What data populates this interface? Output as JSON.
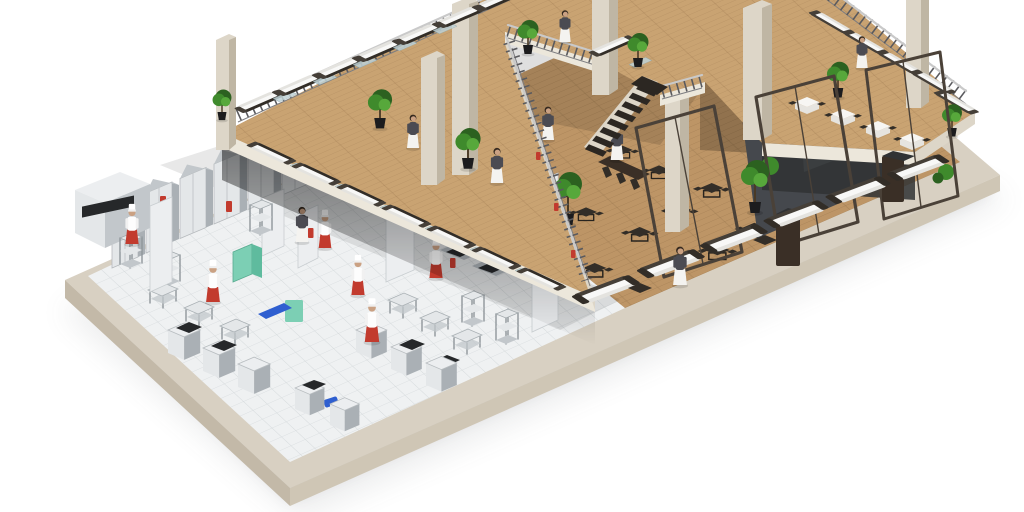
{
  "image": {
    "width": 1024,
    "height": 512,
    "alt": "3D isometric cutaway rendering of a two-storey restaurant"
  },
  "scene": {
    "style": "photorealistic 3D isometric cutaway architectural render on white background",
    "subject": "Two-storey restaurant interior: open commercial kitchen on the ground floor and a lounge dining mezzanine above",
    "background_color": "#ffffff",
    "levels": [
      {
        "name": "ground-floor",
        "areas": [
          {
            "name": "commercial-kitchen",
            "floor": "white ceramic tile",
            "equipment": [
              "tall stainless refrigerator cabinets",
              "stainless prep tables",
              "wire shelving racks",
              "ranges with black cooktops",
              "black-front oven",
              "teal dishwasher machine",
              "blue prep bins",
              "red wall panels"
            ],
            "staff": "chefs"
          },
          {
            "name": "dining-hall",
            "floor": "oak plank",
            "furniture": [
              "dark square tables with chairs",
              "long communal table",
              "framed glass partition walls",
              "dark host cabinets",
              "potted ficus trees",
              "railing with red accents"
            ],
            "staff": "waitresses"
          },
          {
            "name": "terrace-edge-lounge",
            "floor": "beige walkway strip",
            "furniture": [
              "rattan sofas with white cushions",
              "dark side tables"
            ]
          }
        ]
      },
      {
        "name": "mezzanine",
        "areas": [
          {
            "name": "lounge-terrace",
            "floor": "oak plank",
            "furniture": [
              "rattan sofas with white cushions",
              "glass coffee tables",
              "boxwood topiaries in black planters"
            ]
          },
          {
            "name": "balcony-dining",
            "floor": "oak plank",
            "furniture": [
              "tables with white linens",
              "dark chairs",
              "rattan sofas"
            ]
          },
          {
            "name": "connecting-walkway",
            "features": [
              "steel railings",
              "open staircase to ground floor"
            ]
          }
        ]
      }
    ],
    "structure": {
      "columns_count": 8,
      "glass_partition_count": 3,
      "staircase_steps": 8,
      "base_platform": "beige slab with soft drop shadow"
    },
    "figures": {
      "chefs": {
        "count": 6,
        "uniform": {
          "jacket": "#ffffff",
          "apron": "#c23b2e",
          "hat": "#ffffff"
        }
      },
      "waitresses": {
        "count": 8,
        "uniform": {
          "top": "#4b4b52",
          "apron_skirt": "#f4f3f0",
          "hair": "#35291f"
        }
      }
    },
    "furniture_counts": {
      "mezzanine_sofas": 20,
      "glass_coffee_tables": 16,
      "ground_lounge_sofas": 6,
      "white_linen_tables": 4,
      "dark_dining_tables": 13,
      "communal_tables": 1,
      "topiary_plants": 9,
      "ground_trees": 2
    },
    "palette": {
      "bg": "#ffffff",
      "slab-top": "#d8d0c2",
      "slab-side": "#c3b9a8",
      "slab-side2": "#cfc6b5",
      "fascia": "#ece7db",
      "fascia-dk": "#ddd6c8",
      "kitchen-floor": "#eff1f2",
      "kitchen-line": "#d5dadc",
      "wood": "#bd9566",
      "wood-line": "#97744b",
      "wood-mezz": "#c9a372",
      "steel-light": "#e4e7e9",
      "steel-mid": "#c2c7cb",
      "steel-dark": "#8f969b",
      "steel-side": "#aab0b5",
      "white-unit": "#eceef0",
      "black-top": "#26282a",
      "teal": "#7ccfb4",
      "blue": "#2f5fd0",
      "red": "#c23b2e",
      "sofa-frame": "#453f38",
      "sofa-frame-dark": "#322d27",
      "cushion": "#f8f8f7",
      "cushion-shade": "#e4e3df",
      "glass-table": "#bfd2d6",
      "plant-dark": "#2c6120",
      "plant-mid": "#3f8a2c",
      "plant-light": "#57a83b",
      "pot": "#1c1c1e",
      "column-light": "#ddd6c8",
      "column-dark": "#bfb6a4",
      "railing-rail": "#c9c9c9",
      "railing-post": "#5a5a5e",
      "glass-fill": "rgba(150,168,175,0.38)",
      "glass-frame": "#4a4138",
      "charcoal": "#45484d",
      "charcoal-dark": "#303234",
      "stair": "#2c2722",
      "table-dark": "#332e28",
      "host-brown": "#3a2f26",
      "skin": "#caa183",
      "waitress-top": "#4b4b52",
      "apron-white": "#f4f3f0",
      "hair": "#35291f",
      "shadow": "#5c6166"
    }
  }
}
